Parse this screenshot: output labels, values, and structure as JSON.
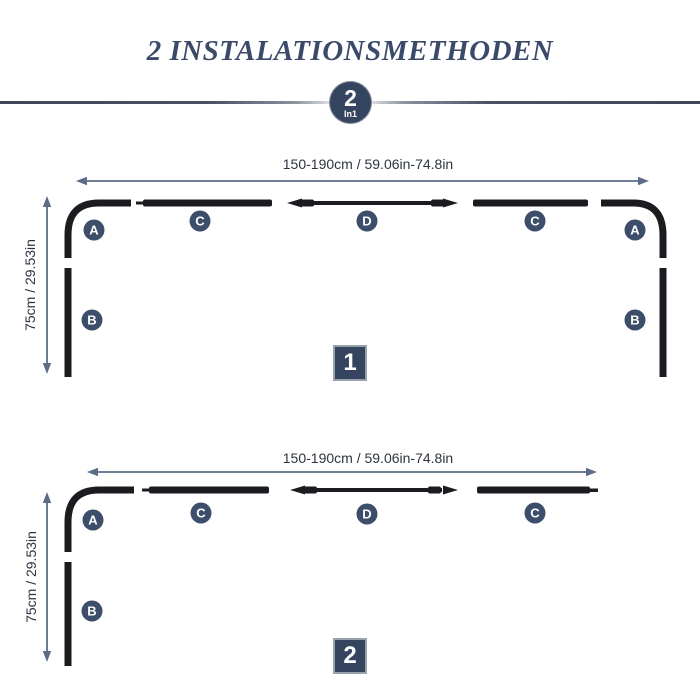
{
  "title": "2 INSTALATIONSMETHODEN",
  "divider_badge": {
    "number": "2",
    "subtext": "In1"
  },
  "diagram1": {
    "badge": "1",
    "width_dimension": "150-190cm / 59.06in-74.8in",
    "height_dimension": "75cm / 29.53in",
    "labels": {
      "a_left": "A",
      "b_left": "B",
      "c_left": "C",
      "d": "D",
      "c_right": "C",
      "a_right": "A",
      "b_right": "B"
    }
  },
  "diagram2": {
    "badge": "2",
    "width_dimension": "150-190cm / 59.06in-74.8in",
    "height_dimension": "75cm / 29.53in",
    "labels": {
      "a": "A",
      "b": "B",
      "c_left": "C",
      "d": "D",
      "c_right": "C"
    }
  },
  "colors": {
    "title": "#3a4a68",
    "navy_badge": "#35455f",
    "label_circle": "#3d4e6a",
    "rod": "#1b1c1f",
    "dimension_arrow": "#5c6c88",
    "dimension_text": "#2e3440"
  }
}
